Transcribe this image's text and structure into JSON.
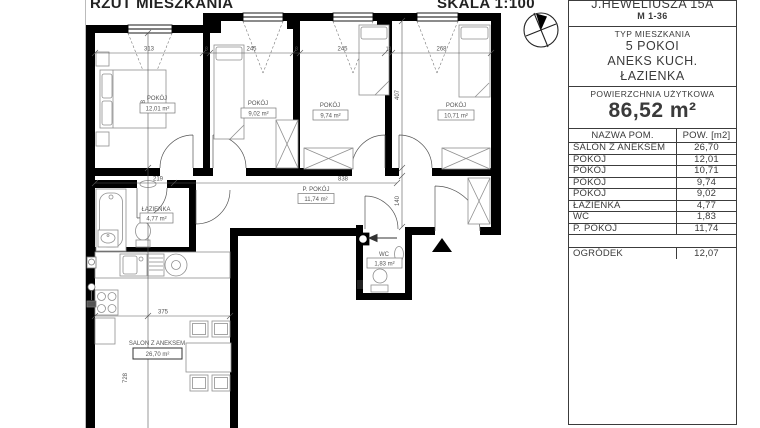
{
  "header": {
    "title": "RZUT MIESZKANIA",
    "scale": "SKALA 1:100"
  },
  "panel": {
    "address": "J.HEWELIUSZA 15A",
    "unit": "M 1-36",
    "type_label": "TYP MIESZKANIA",
    "type_lines": [
      "5 POKOI",
      "ANEKS KUCH.",
      "ŁAZIENKA"
    ],
    "area_label": "POWIERZCHNIA UŻYTKOWA",
    "area_value": "86,52 m²",
    "table": {
      "col_name": "NAZWA POM.",
      "col_area": "POW. [m2]",
      "rows": [
        [
          "SALON Z ANEKSEM",
          "26,70"
        ],
        [
          "POKÓJ",
          "12,01"
        ],
        [
          "POKÓJ",
          "10,71"
        ],
        [
          "POKÓJ",
          "9,74"
        ],
        [
          "POKÓJ",
          "9,02"
        ],
        [
          "ŁAZIENKA",
          "4,77"
        ],
        [
          "WC",
          "1,83"
        ],
        [
          "P. POKÓJ",
          "11,74"
        ]
      ],
      "garden": [
        "OGRÓDEK",
        "12,07"
      ]
    }
  },
  "plan": {
    "rooms": [
      {
        "name": "POKÓJ",
        "area": "12,01 m²"
      },
      {
        "name": "POKÓJ",
        "area": "9,02 m²"
      },
      {
        "name": "POKÓJ",
        "area": "9,74 m²"
      },
      {
        "name": "POKÓJ",
        "area": "10,71 m²"
      },
      {
        "name": "P. POKÓJ",
        "area": "11,74 m²"
      },
      {
        "name": "ŁAZIENKA",
        "area": "4,77 m²"
      },
      {
        "name": "WC",
        "area": "1,83 m²"
      },
      {
        "name": "SALON Z ANEKSEM",
        "area": "26,70 m²"
      }
    ],
    "dims": {
      "w1": "313",
      "t1": "8",
      "w2": "245",
      "t2": "8",
      "w3": "245",
      "t3": "18",
      "w4": "268",
      "h1": "368",
      "h2": "407",
      "corr_w": "140",
      "corr_l": "838",
      "bath": "219",
      "salon_w": "375",
      "salon_h": "728"
    }
  }
}
